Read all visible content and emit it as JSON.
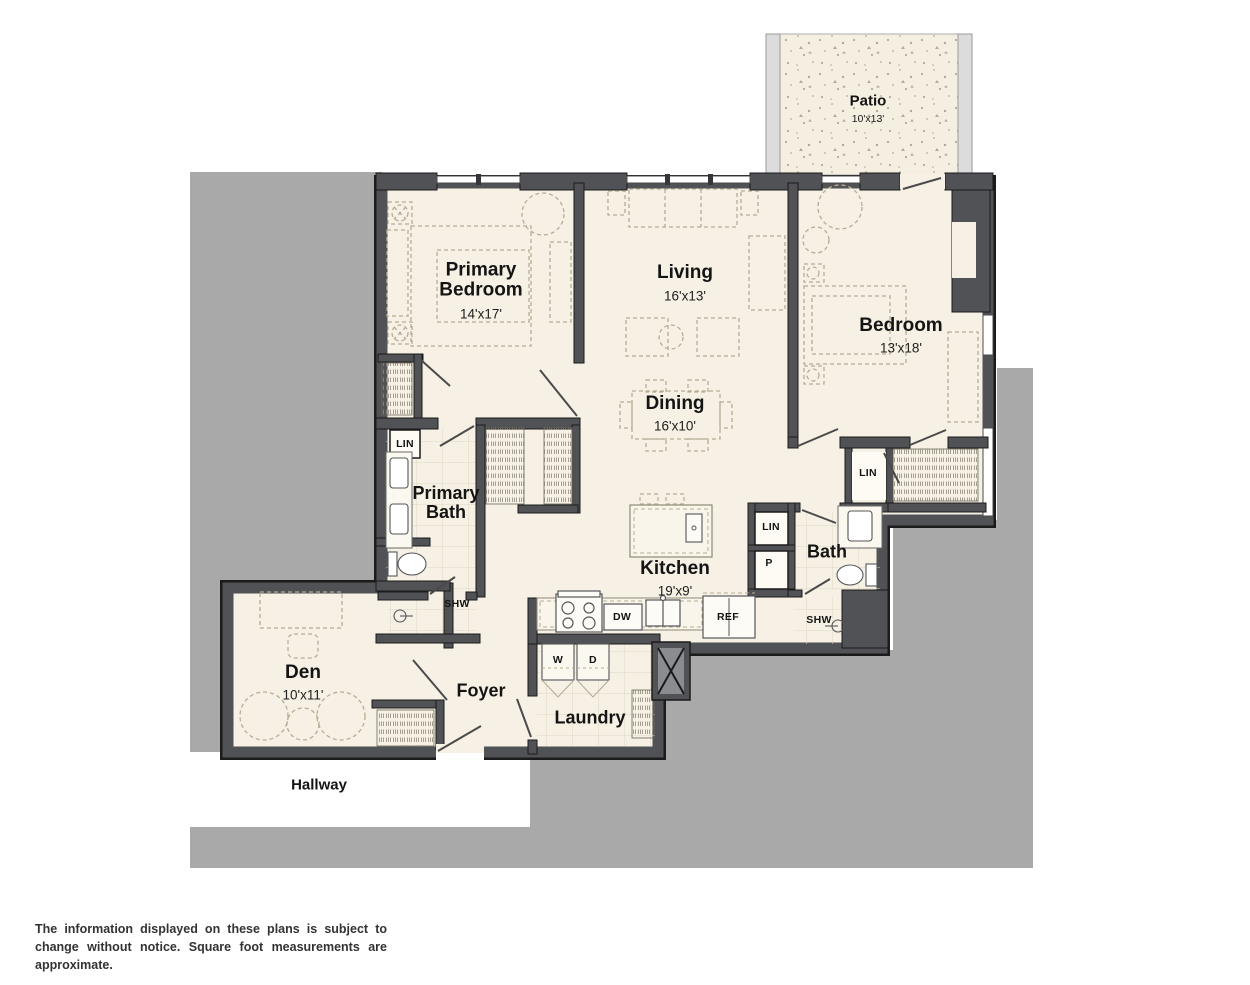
{
  "palette": {
    "background_grey": "#a9a9a9",
    "wall_dark": "#515256",
    "wall_outline": "#1b1b1b",
    "floor_cream": "#f6f1e4",
    "furniture_dash": "#b5ad97",
    "tile_line": "#ddd6c3",
    "text": "#141414"
  },
  "rooms": [
    {
      "name": "Patio",
      "dims": "10'x13'"
    },
    {
      "name": "Primary Bedroom",
      "dims": "14'x17'"
    },
    {
      "name": "Living",
      "dims": "16'x13'"
    },
    {
      "name": "Bedroom",
      "dims": "13'x18'"
    },
    {
      "name": "Dining",
      "dims": "16'x10'"
    },
    {
      "name": "Primary Bath",
      "dims": ""
    },
    {
      "name": "Kitchen",
      "dims": "19'x9'"
    },
    {
      "name": "Bath",
      "dims": ""
    },
    {
      "name": "Den",
      "dims": "10'x11'"
    },
    {
      "name": "Foyer",
      "dims": ""
    },
    {
      "name": "Laundry",
      "dims": ""
    },
    {
      "name": "Hallway",
      "dims": ""
    }
  ],
  "fixtures": {
    "linen_primary": "LIN",
    "shower_primary": "SHW",
    "linen_bedroom": "LIN",
    "linen_bath": "LIN",
    "pantry": "P",
    "shower_bath": "SHW",
    "washer": "W",
    "dryer": "D",
    "dishwasher": "DW",
    "refrigerator": "REF"
  },
  "disclaimer": "The information displayed on these plans is subject to change without notice. Square foot measurements are approximate."
}
